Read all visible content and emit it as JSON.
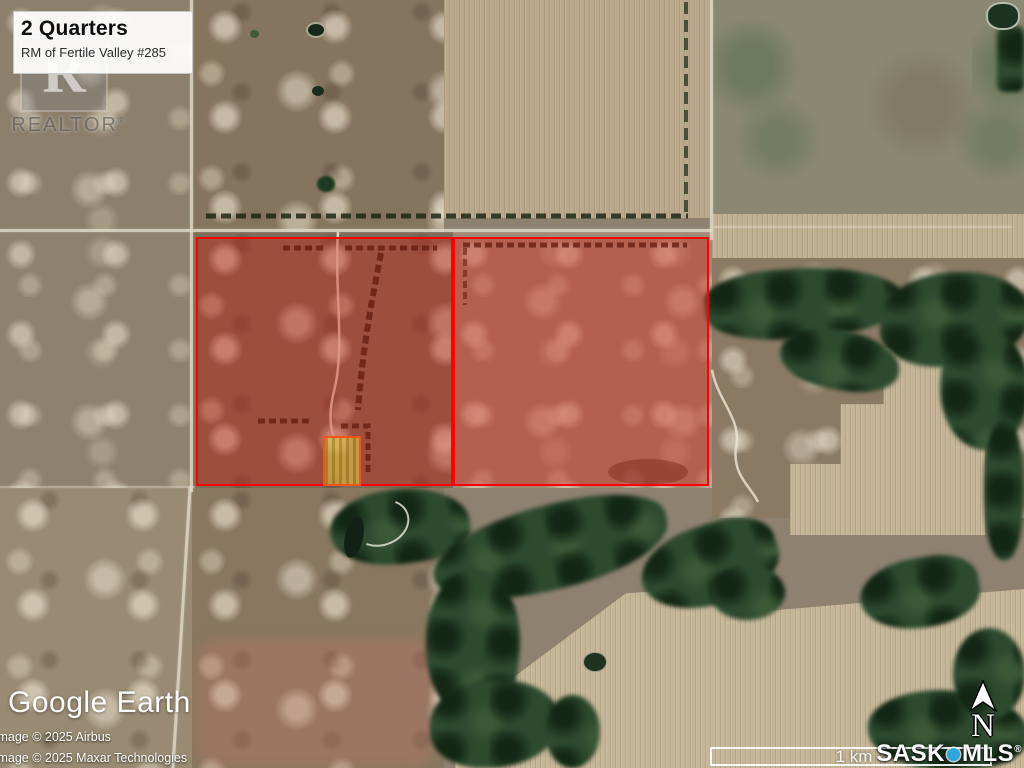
{
  "colors": {
    "parcel_outline": "#ff0000",
    "parcel_fill": "rgba(214,28,18,0.38)",
    "exclusion_outline": "#f4531a",
    "exclusion_fill": "rgba(233,215,70,0.55)",
    "mls_dot": "#2ba7e0"
  },
  "listing_card": {
    "title": "2 Quarters",
    "subtitle": "RM of Fertile Valley #285"
  },
  "realtor_logo": {
    "letter": "R",
    "label": "REALTOR",
    "registered": "®"
  },
  "attribution": {
    "wordmark": "Google Earth",
    "line1": "Image © 2025 Airbus",
    "line2": "Image © 2025 Maxar Technologies"
  },
  "scale_bar": {
    "label": "1 km"
  },
  "mls_logo": {
    "prefix": "SASK",
    "suffix": "MLS",
    "registered": "®"
  },
  "north_indicator": {
    "label": "N"
  }
}
